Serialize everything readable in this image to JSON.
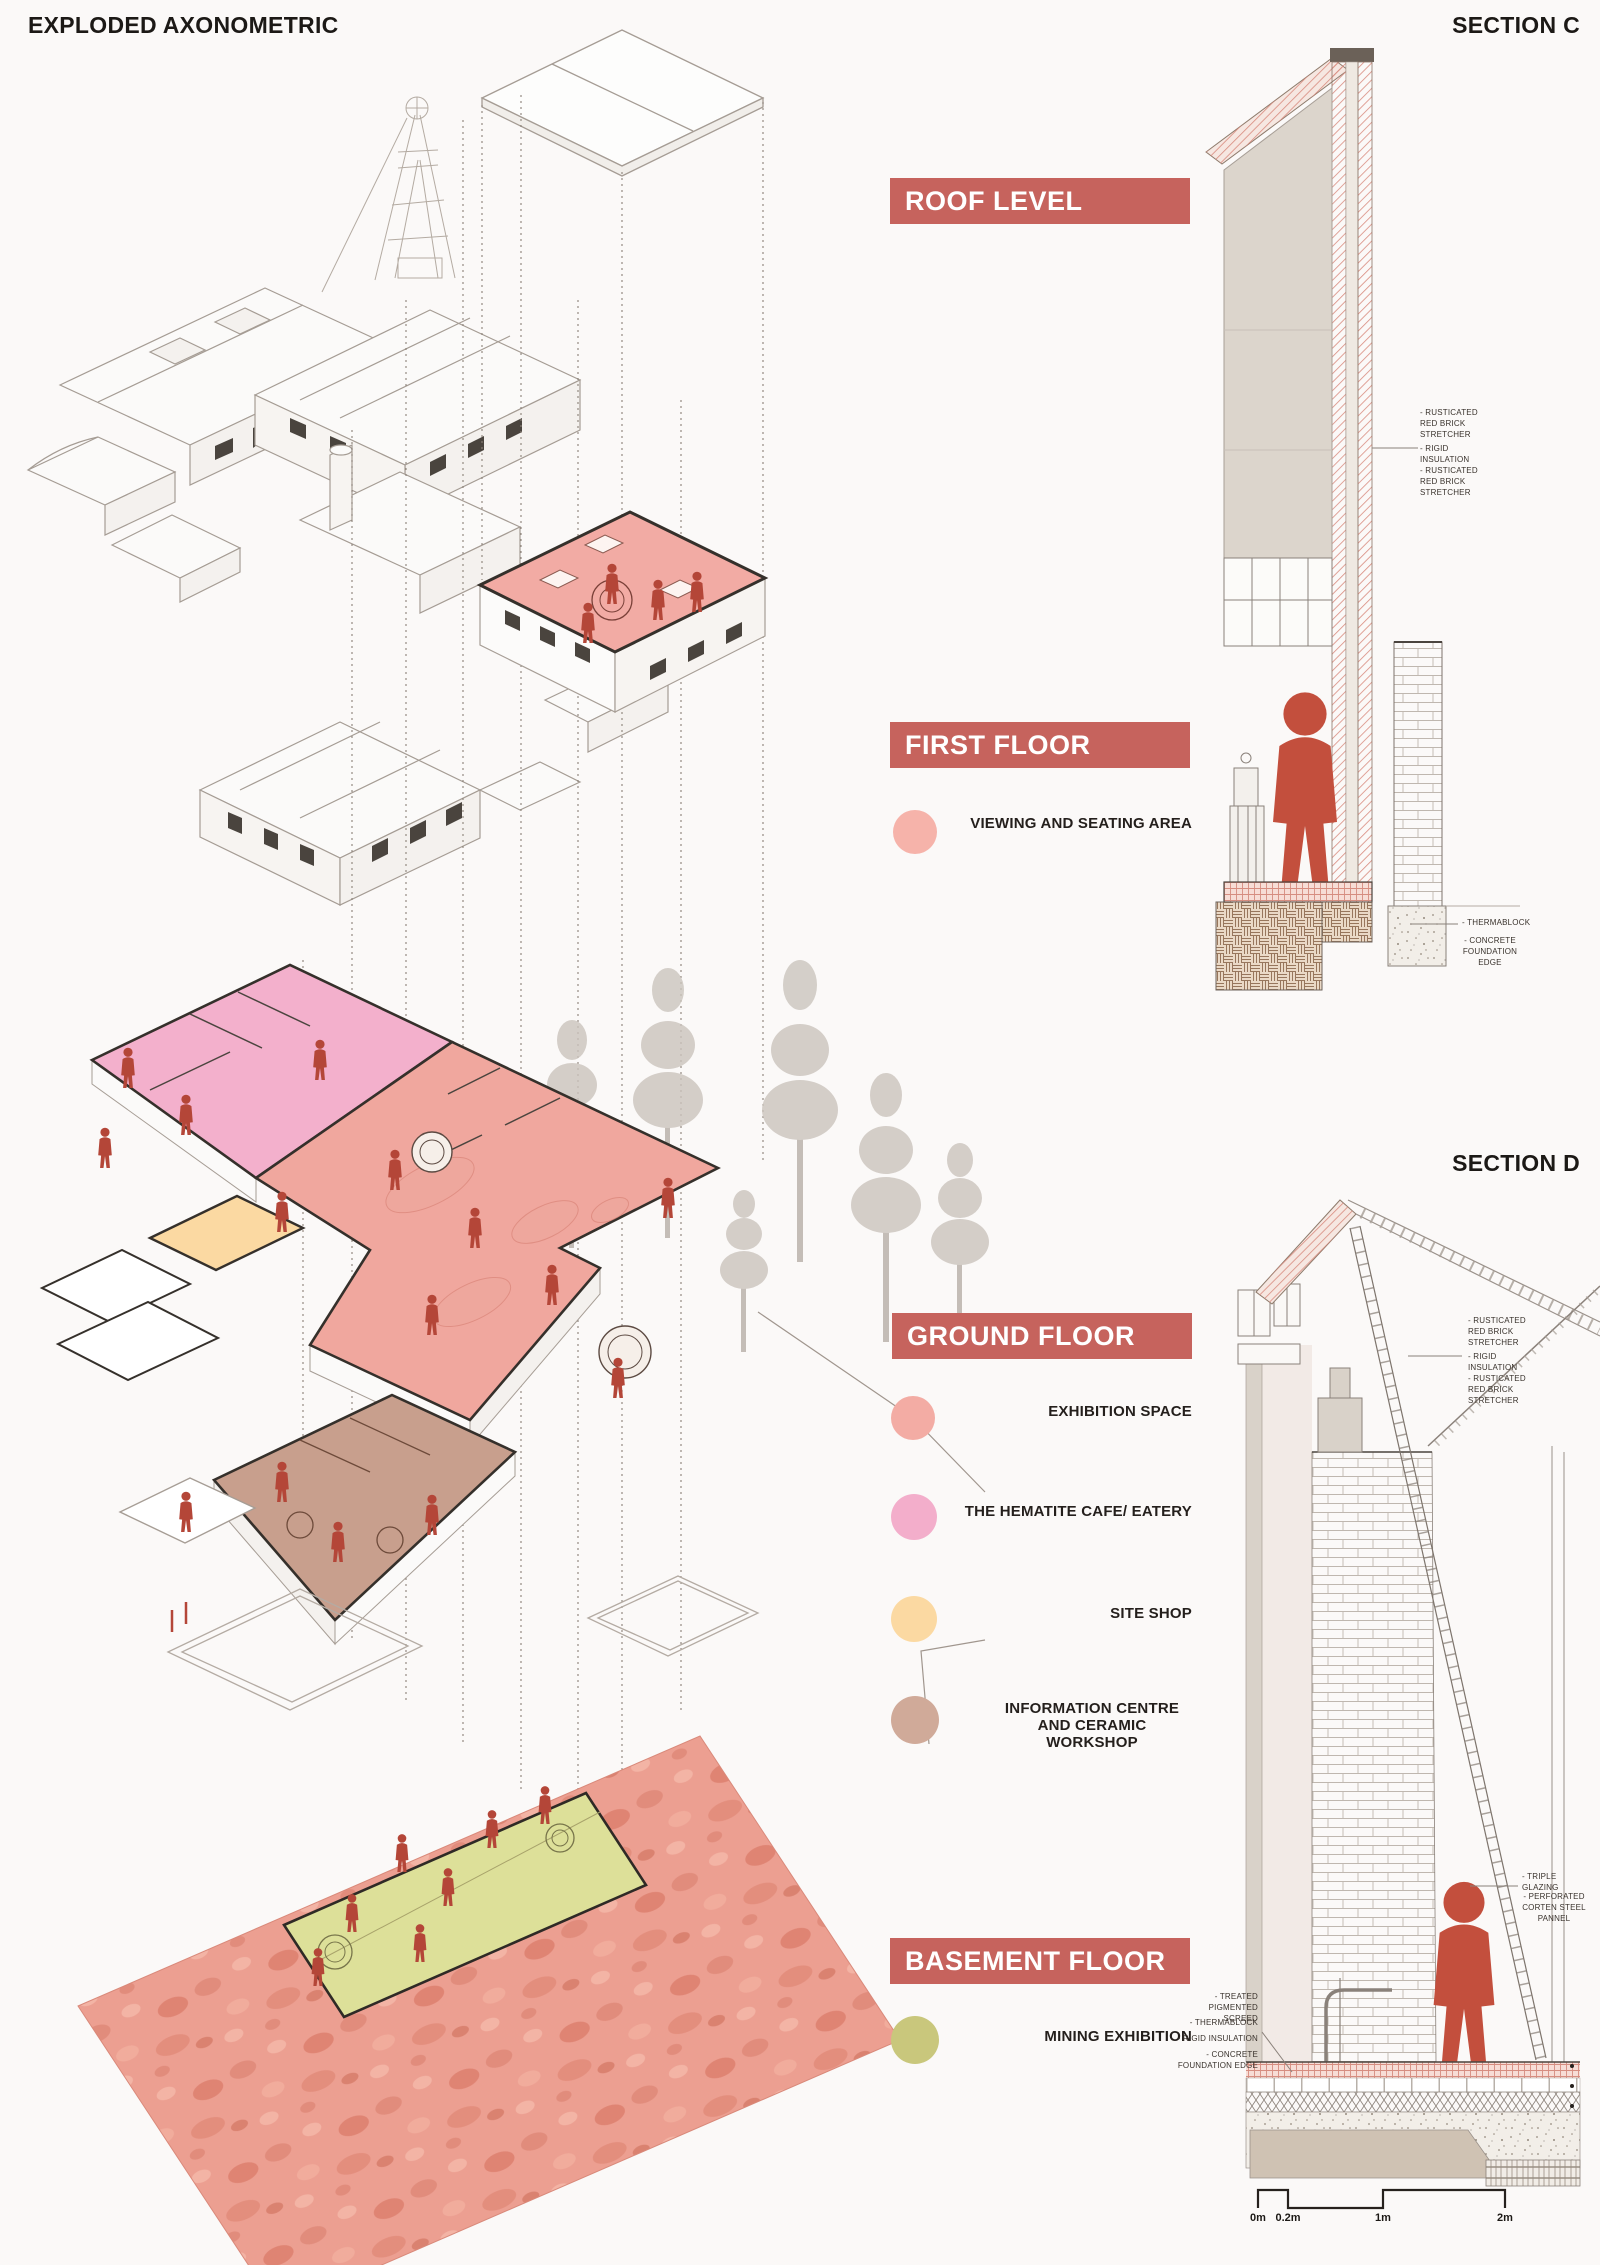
{
  "header": {
    "title": "EXPLODED AXONOMETRIC"
  },
  "levels": {
    "roof": {
      "banner": "ROOF LEVEL"
    },
    "first": {
      "banner": "FIRST FLOOR",
      "legend": [
        {
          "label": "VIEWING AND SEATING AREA",
          "color": "#f6b3aa"
        }
      ]
    },
    "ground": {
      "banner": "GROUND FLOOR",
      "legend": [
        {
          "label": "EXHIBITION SPACE",
          "color": "#f3aca4"
        },
        {
          "label": "THE HEMATITE CAFE/ EATERY",
          "color": "#f3aecb"
        },
        {
          "label": "SITE SHOP",
          "color": "#fbd9a2"
        },
        {
          "label": "INFORMATION CENTRE AND CERAMIC WORKSHOP",
          "color": "#d0aa99"
        }
      ]
    },
    "basement": {
      "banner": "BASEMENT FLOOR",
      "legend": [
        {
          "label": "MINING EXHIBITION",
          "color": "#c9c77c"
        }
      ]
    }
  },
  "sections": {
    "c": {
      "title": "SECTION C",
      "annotations_top": [
        "- RUSTICATED RED BRICK STRETCHER",
        "- RIGID INSULATION",
        "- RUSTICATED RED BRICK STRETCHER"
      ],
      "annotations_bottom": [
        "- THERMABLOCK",
        "- CONCRETE FOUNDATION EDGE"
      ]
    },
    "d": {
      "title": "SECTION D",
      "annotations_top": [
        "- RUSTICATED RED BRICK STRETCHER",
        "- RIGID INSULATION",
        "- RUSTICATED RED BRICK STRETCHER"
      ],
      "annotations_mid": [
        "- TRIPLE GLAZING",
        "- PERFORATED CORTEN STEEL PANNEL"
      ],
      "annotations_bottom": [
        "- TREATED PIGMENTED SCREED",
        "- THERMABLOCK",
        "- RIGID INSULATION",
        "- CONCRETE FOUNDATION EDGE"
      ]
    }
  },
  "scale_bar": {
    "labels": [
      "0m",
      "0.2m",
      "1m",
      "2m"
    ]
  },
  "colors": {
    "banner_red": "#c6635d",
    "figure_red": "#b44638",
    "section_figure_red": "#c34f3d",
    "first_floor_fill": "#f2aba4",
    "exhibition_fill": "#f0a79e",
    "cafe_fill": "#f3b0cc",
    "site_shop_fill": "#fbd9a2",
    "info_centre_fill": "#c89f8d",
    "mining_fill": "#dde099",
    "basement_band": "#ec9f91"
  }
}
